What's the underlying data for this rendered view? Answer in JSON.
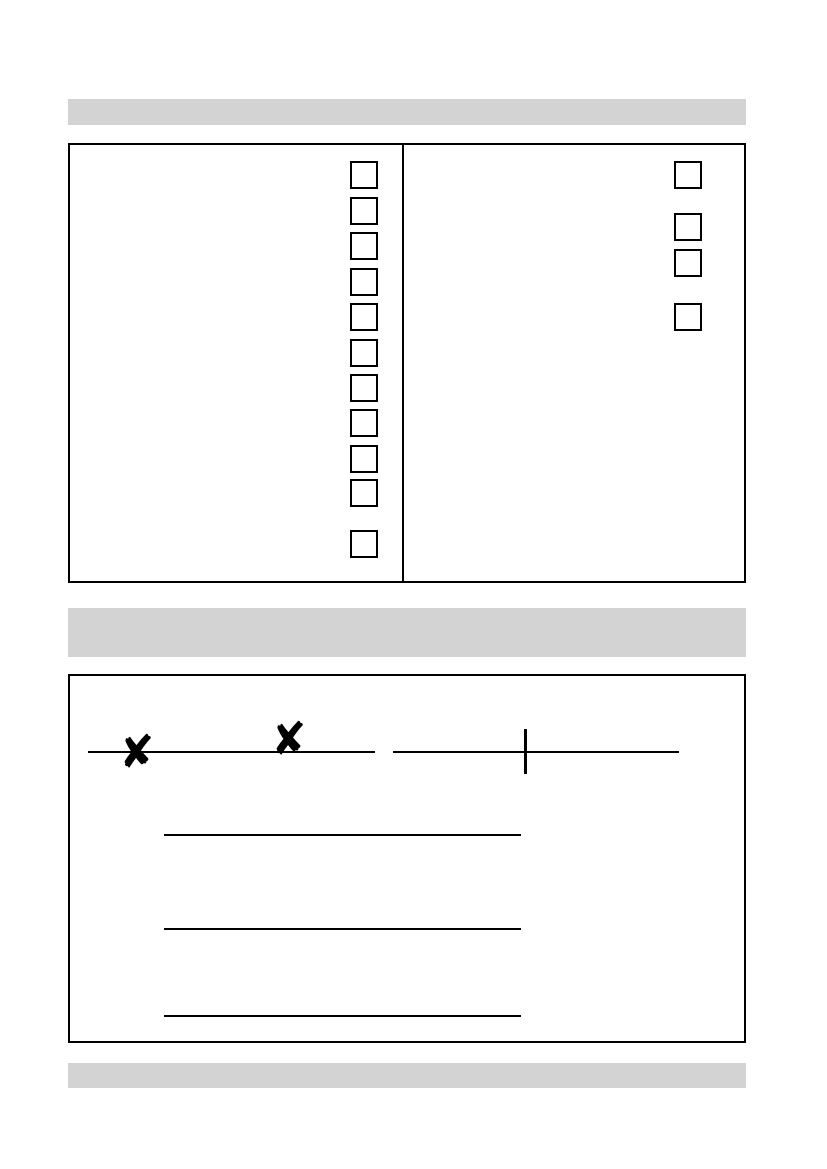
{
  "document": {
    "kind": "blank scanned form page",
    "background_color": "#ffffff"
  },
  "colors": {
    "section_bar_fill": "#d3d3d3",
    "line_color": "#000000",
    "mark_color": "#000000"
  },
  "sections": {
    "top": {
      "bar_label": "",
      "checkbox_box": {
        "left_column_checkbox_count": 11,
        "right_column_checkbox_count": 4,
        "all_checkboxes_state": "unchecked"
      }
    },
    "middle": {
      "bar_label": "",
      "x_mark": "✘",
      "x_mark_count": 2,
      "tick_mark_count": 1,
      "top_rule_count": 2,
      "signature_line_count": 3
    },
    "bottom": {
      "bar_label": ""
    }
  }
}
